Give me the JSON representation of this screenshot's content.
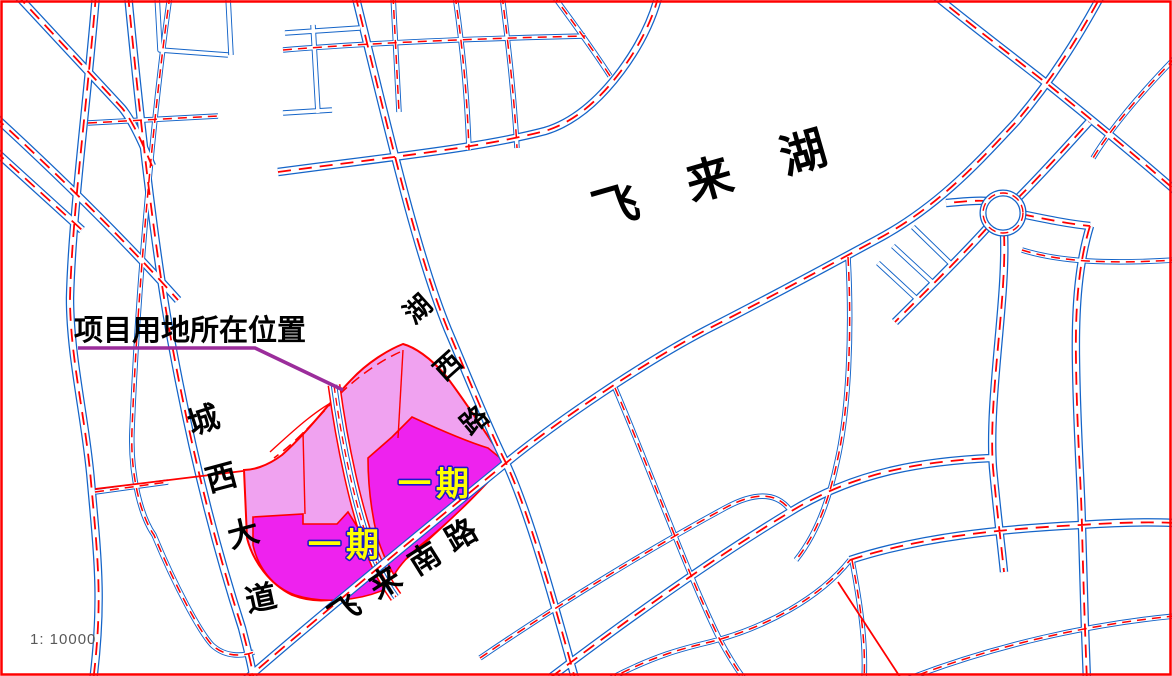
{
  "map": {
    "scale_label": "1: 10000",
    "lake_label": "飞 来 湖",
    "callout": {
      "text": "项目用地所在位置"
    },
    "phase_labels": [
      "一期",
      "一期"
    ],
    "roads": {
      "huxi": {
        "name": "湖西路",
        "chars": [
          "湖",
          "西",
          "路"
        ]
      },
      "chengxi": {
        "name": "城西大道",
        "chars": [
          "城",
          "西",
          "大",
          "道"
        ]
      },
      "feilai_south": {
        "name": "飞来南路",
        "chars": [
          "飞",
          "来",
          "南",
          "路"
        ]
      }
    },
    "colors": {
      "road_blue": "#1464C8",
      "road_red": "#FF0000",
      "parcel_light": "#F0A2F0",
      "parcel_bright": "#EE22EE",
      "callout_purple": "#9B2D9B",
      "phase_fill": "#FFFF00",
      "phase_outline": "#1A1ACC",
      "scale_gray": "#595959"
    }
  }
}
